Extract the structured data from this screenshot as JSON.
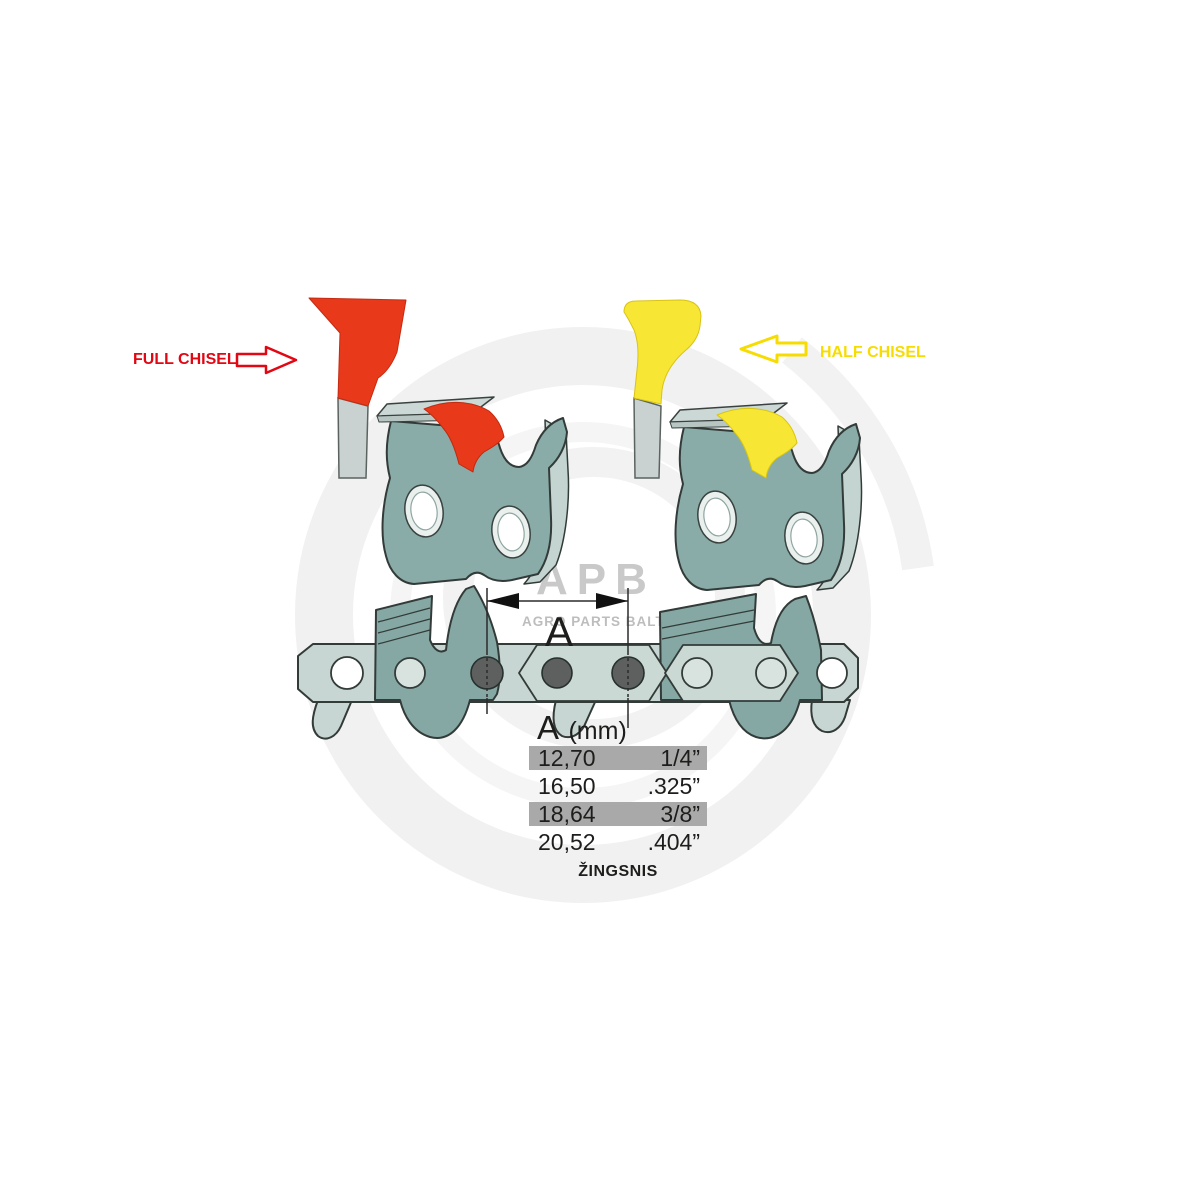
{
  "annotations": {
    "full_chisel_label": "FULL CHISEL",
    "half_chisel_label": "HALF CHISEL"
  },
  "dimension": {
    "arrow_label": "A"
  },
  "pitch_table": {
    "header_symbol": "A",
    "header_unit": "(mm)",
    "rows": [
      {
        "mm": "12,70",
        "inch": "1/4”",
        "highlighted": true
      },
      {
        "mm": "16,50",
        "inch": ".325”",
        "highlighted": false
      },
      {
        "mm": "18,64",
        "inch": "3/8”",
        "highlighted": true
      },
      {
        "mm": "20,52",
        "inch": ".404”",
        "highlighted": false
      }
    ],
    "caption": "ŽINGSNIS"
  },
  "watermark": {
    "logo_text": "APB",
    "tagline": "AGRO PARTS BALTIJA"
  },
  "colors": {
    "full_chisel_red": "#e8391b",
    "half_chisel_yellow": "#f7e634",
    "label_red": "#e30613",
    "label_yellow": "#f6dc00",
    "link_body_teal": "#8aaca8",
    "chain_band_green": "#c7d6d2",
    "rivet_gray": "#5e605f",
    "table_row_gray": "#a9a9a9",
    "watermark_gray": "#c9c9c9"
  }
}
